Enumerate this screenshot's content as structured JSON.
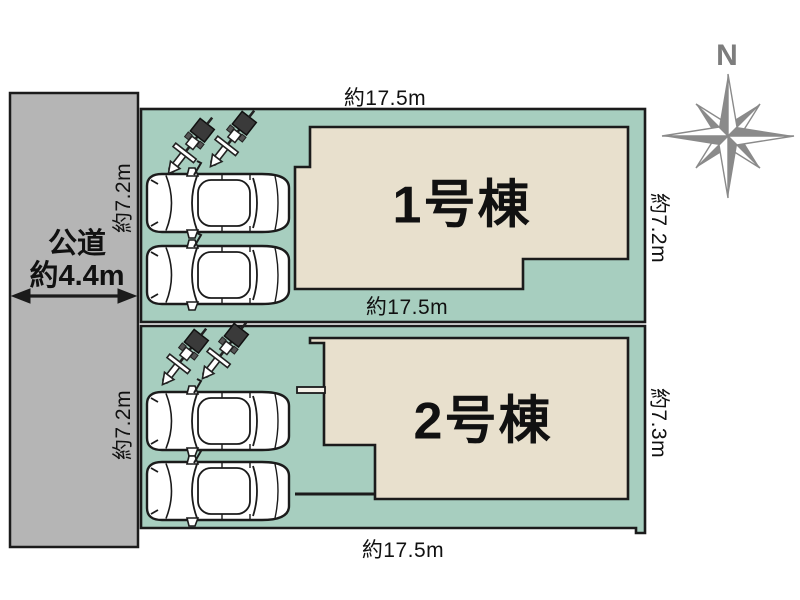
{
  "compass": {
    "north_label": "N"
  },
  "road": {
    "name": "公道",
    "width": "約4.4m"
  },
  "plots": [
    {
      "building_label": "1号棟",
      "dim_top": "約17.5m",
      "dim_left": "約7.2m",
      "dim_right": "約7.2m",
      "dim_bottom": "約17.5m"
    },
    {
      "building_label": "2号棟",
      "dim_left": "約7.2m",
      "dim_right": "約7.3m",
      "dim_bottom": "約17.5m"
    }
  ],
  "colors": {
    "plot-green": "#a7cebf",
    "building-beige": "#e8e0cd",
    "road-gray": "#b5b5b5",
    "outline": "#1b1b1b",
    "compass-gray": "#8a8a8a"
  }
}
